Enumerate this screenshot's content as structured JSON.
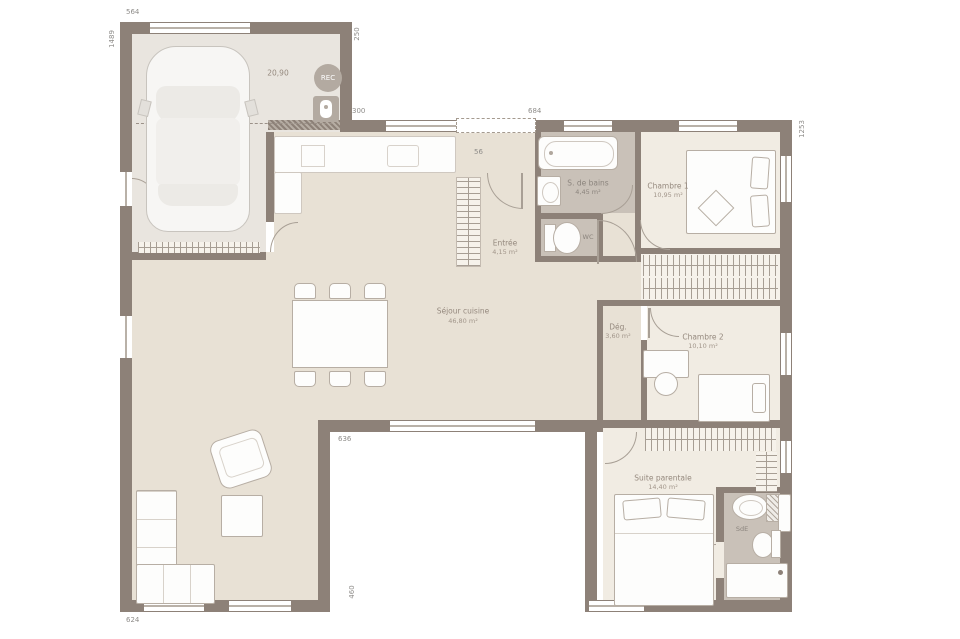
{
  "rooms": {
    "garage": {
      "area": "20,90"
    },
    "sejour": {
      "name": "Séjour cuisine",
      "area": "46,80 m²"
    },
    "entree": {
      "name": "Entrée",
      "area": "4,15 m²"
    },
    "salle_de_bains": {
      "name": "S. de bains",
      "area": "4,45 m²"
    },
    "wc": {
      "name": "WC"
    },
    "chambre1": {
      "name": "Chambre 1",
      "area": "10,95 m²"
    },
    "degagement": {
      "name": "Dég.",
      "area": "3,60 m²"
    },
    "chambre2": {
      "name": "Chambre 2",
      "area": "10,10 m²"
    },
    "suite": {
      "name": "Suite parentale",
      "area": "14,40 m²"
    },
    "salle_eau": {
      "name": "SdE"
    }
  },
  "dimensions": {
    "top_garage": "564",
    "left_height": "1489",
    "garage_offset": "250",
    "garage_house_gap": "300",
    "front_width": "684",
    "porch_depth": "56",
    "right_height": "1253",
    "patio_width": "636",
    "patio_height": "460",
    "bottom_left_width": "624"
  },
  "badges": {
    "rec": "REC"
  },
  "colors": {
    "wall": "#8d8178",
    "floor_living": "#e8e1d5",
    "floor_bedroom": "#f1ece3",
    "floor_wet": "#c9c1b8",
    "floor_garage": "#e9e5df"
  }
}
